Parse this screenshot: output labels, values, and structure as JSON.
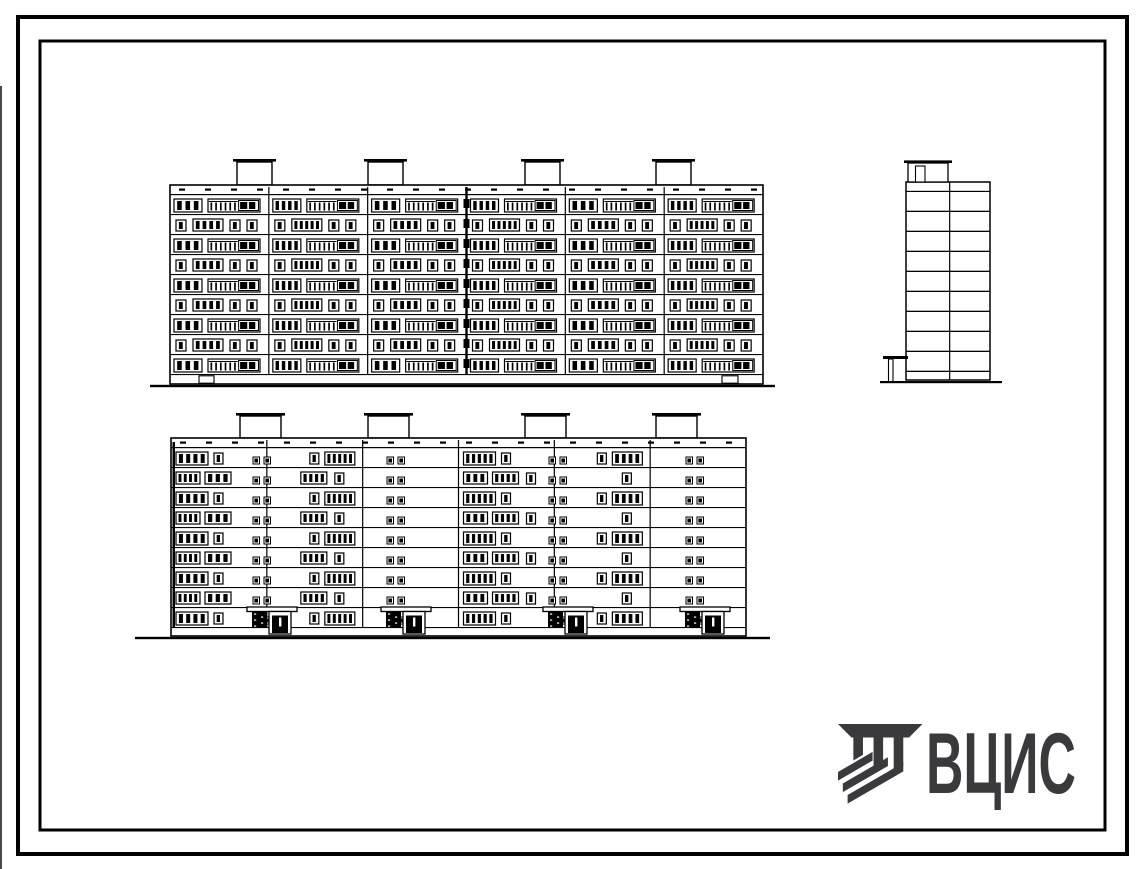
{
  "paper": "#ffffff",
  "ink": "#000000",
  "scan_artifact": {
    "color": "#4a4a4a",
    "x": 0,
    "y": 86,
    "w": 2,
    "h": 783
  },
  "frames": {
    "outer": {
      "x": 18,
      "y": 17,
      "w": 1109,
      "h": 837,
      "stroke": 4
    },
    "inner": {
      "x": 40,
      "y": 41,
      "w": 1065,
      "h": 789,
      "stroke": 3
    }
  },
  "logo": {
    "text": "ВЦИС",
    "color": "#3a3a3c",
    "text_x": 926,
    "text_y": 793,
    "font_size": 86,
    "text_length": 150,
    "emblem_x": 838,
    "emblem_y": 724,
    "emblem_scale": 0.96
  },
  "front_elevation": {
    "x": 170,
    "y": 185,
    "w": 593,
    "band_h": 10,
    "floors": 9,
    "floor_h": 20,
    "plinth_h": 9,
    "sections": 6,
    "bulkheads": {
      "xs": [
        237,
        368,
        525,
        656
      ],
      "w": 35,
      "h": 23
    },
    "ground": {
      "x1": 150,
      "x2": 775
    },
    "joint_x_frac": 0.5,
    "basement_marks": [
      {
        "x": 199,
        "w": 15
      },
      {
        "x": 722,
        "w": 16
      }
    ],
    "patterns": {
      "A": [
        {
          "dx": 4,
          "dy": 4,
          "w": 28,
          "h": 13,
          "panes": 3
        },
        {
          "dx": 38,
          "dy": 4,
          "w": 52,
          "h": 13,
          "balcony": true
        }
      ],
      "B": [
        {
          "dx": 6,
          "dy": 5,
          "w": 10,
          "h": 11,
          "panes": 1
        },
        {
          "dx": 23,
          "dy": 4,
          "w": 30,
          "h": 12,
          "panes": 4
        },
        {
          "dx": 60,
          "dy": 5,
          "w": 10,
          "h": 11,
          "panes": 1
        },
        {
          "dx": 77,
          "dy": 5,
          "w": 10,
          "h": 11,
          "panes": 1
        }
      ]
    }
  },
  "rear_elevation": {
    "x": 171,
    "y": 438,
    "w": 575,
    "band_h": 10,
    "floors": 9,
    "floor_h": 20,
    "plinth_h": 8,
    "sections": 6,
    "bulkheads": {
      "xs": [
        240,
        368,
        525,
        656
      ],
      "w": 41,
      "h": 22
    },
    "ground": {
      "x1": 135,
      "x2": 770
    },
    "entrances": {
      "anchors": [
        262,
        396,
        558,
        695
      ]
    },
    "patterns": {
      "A": [
        {
          "dx": 5,
          "dy": 4,
          "w": 32,
          "h": 13,
          "panes": 4
        },
        {
          "dx": 43,
          "dy": 5,
          "w": 9,
          "h": 11,
          "panes": 1
        },
        {
          "dx": 58,
          "dy": 4,
          "w": 30,
          "h": 13,
          "panes": 4
        }
      ],
      "B": [
        {
          "dx": 5,
          "dy": 4,
          "w": 24,
          "h": 12,
          "panes": 3
        },
        {
          "dx": 34,
          "dy": 4,
          "w": 26,
          "h": 12,
          "panes": 3
        },
        {
          "dx": 68,
          "dy": 5,
          "w": 9,
          "h": 11,
          "panes": 1
        }
      ]
    }
  },
  "side_elevation": {
    "x": 906,
    "y": 182,
    "w": 84,
    "h": 198,
    "band_h": 10,
    "floors": 9,
    "floor_h": 20,
    "divider_frac": 0.52,
    "bulkhead": {
      "x": 908,
      "y": 163,
      "w": 40,
      "h": 19,
      "slab_pad": 4,
      "door": {
        "x": 915.5,
        "y": 166,
        "w": 9.5,
        "h": 16
      }
    },
    "canopy": {
      "slab_x": 883,
      "slab_y": 356,
      "slab_w": 25,
      "post_x": 888.5,
      "post_y": 359,
      "post_h": 23
    },
    "ground": {
      "x1": 880,
      "x2": 1002,
      "y": 381
    }
  }
}
